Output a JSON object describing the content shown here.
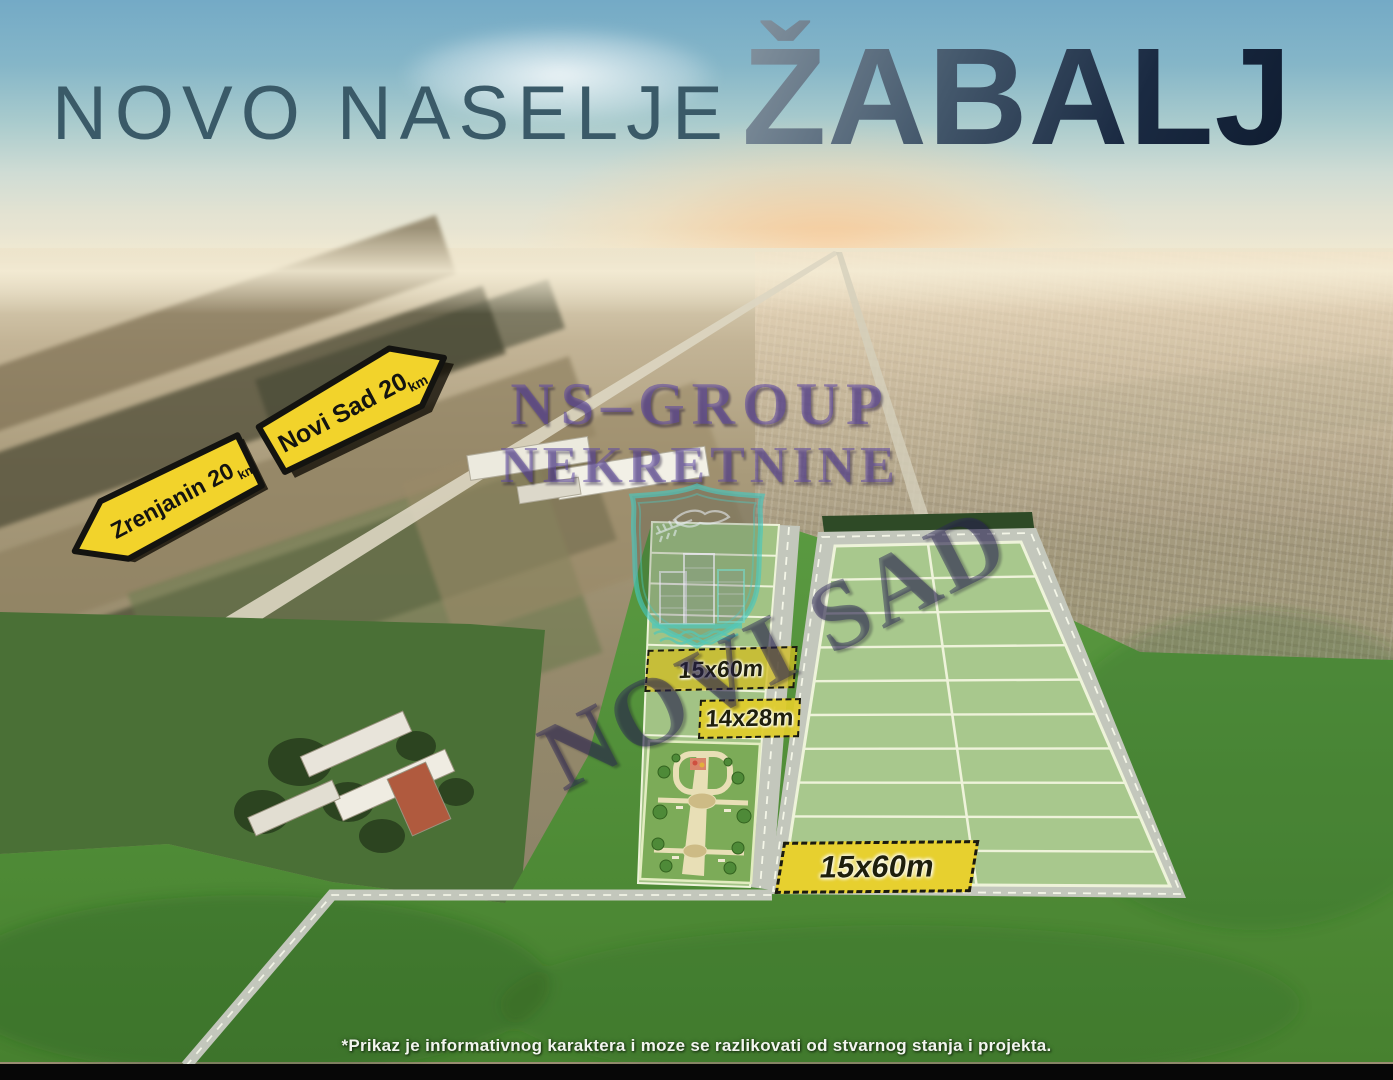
{
  "title": {
    "prefix": "NOVO NASELJE",
    "city": "ŽABALJ"
  },
  "road_signs": {
    "zrenjanin": {
      "label": "Zrenjanin 20",
      "unit": "km",
      "direction": "left"
    },
    "novi_sad": {
      "label": "Novi Sad 20",
      "unit": "km",
      "direction": "right"
    }
  },
  "watermark": {
    "line1": "NS–GROUP",
    "line2": "NEKRETNINE",
    "diagonal": "NOVI SAD",
    "emblem": "novi-sad-coat-of-arms"
  },
  "plot_labels": {
    "strip": "15x60m",
    "center": "14x28m",
    "grid": "15x60m"
  },
  "disclaimer": "*Prikaz je informativnog karaktera i moze se razlikovati od stvarnog stanja i projekta.",
  "colors": {
    "sign_yellow": "#f2d32b",
    "label_yellow": "#e7d02f",
    "plot_green": "#a8c88d",
    "grass_green": "#55923d",
    "road_gray": "#c3c7bc",
    "watermark_purple": "#5c46a0",
    "emblem_teal": "#46c8be",
    "title_dark": "#1b2a3e",
    "sky_blue": "#79aec7"
  }
}
